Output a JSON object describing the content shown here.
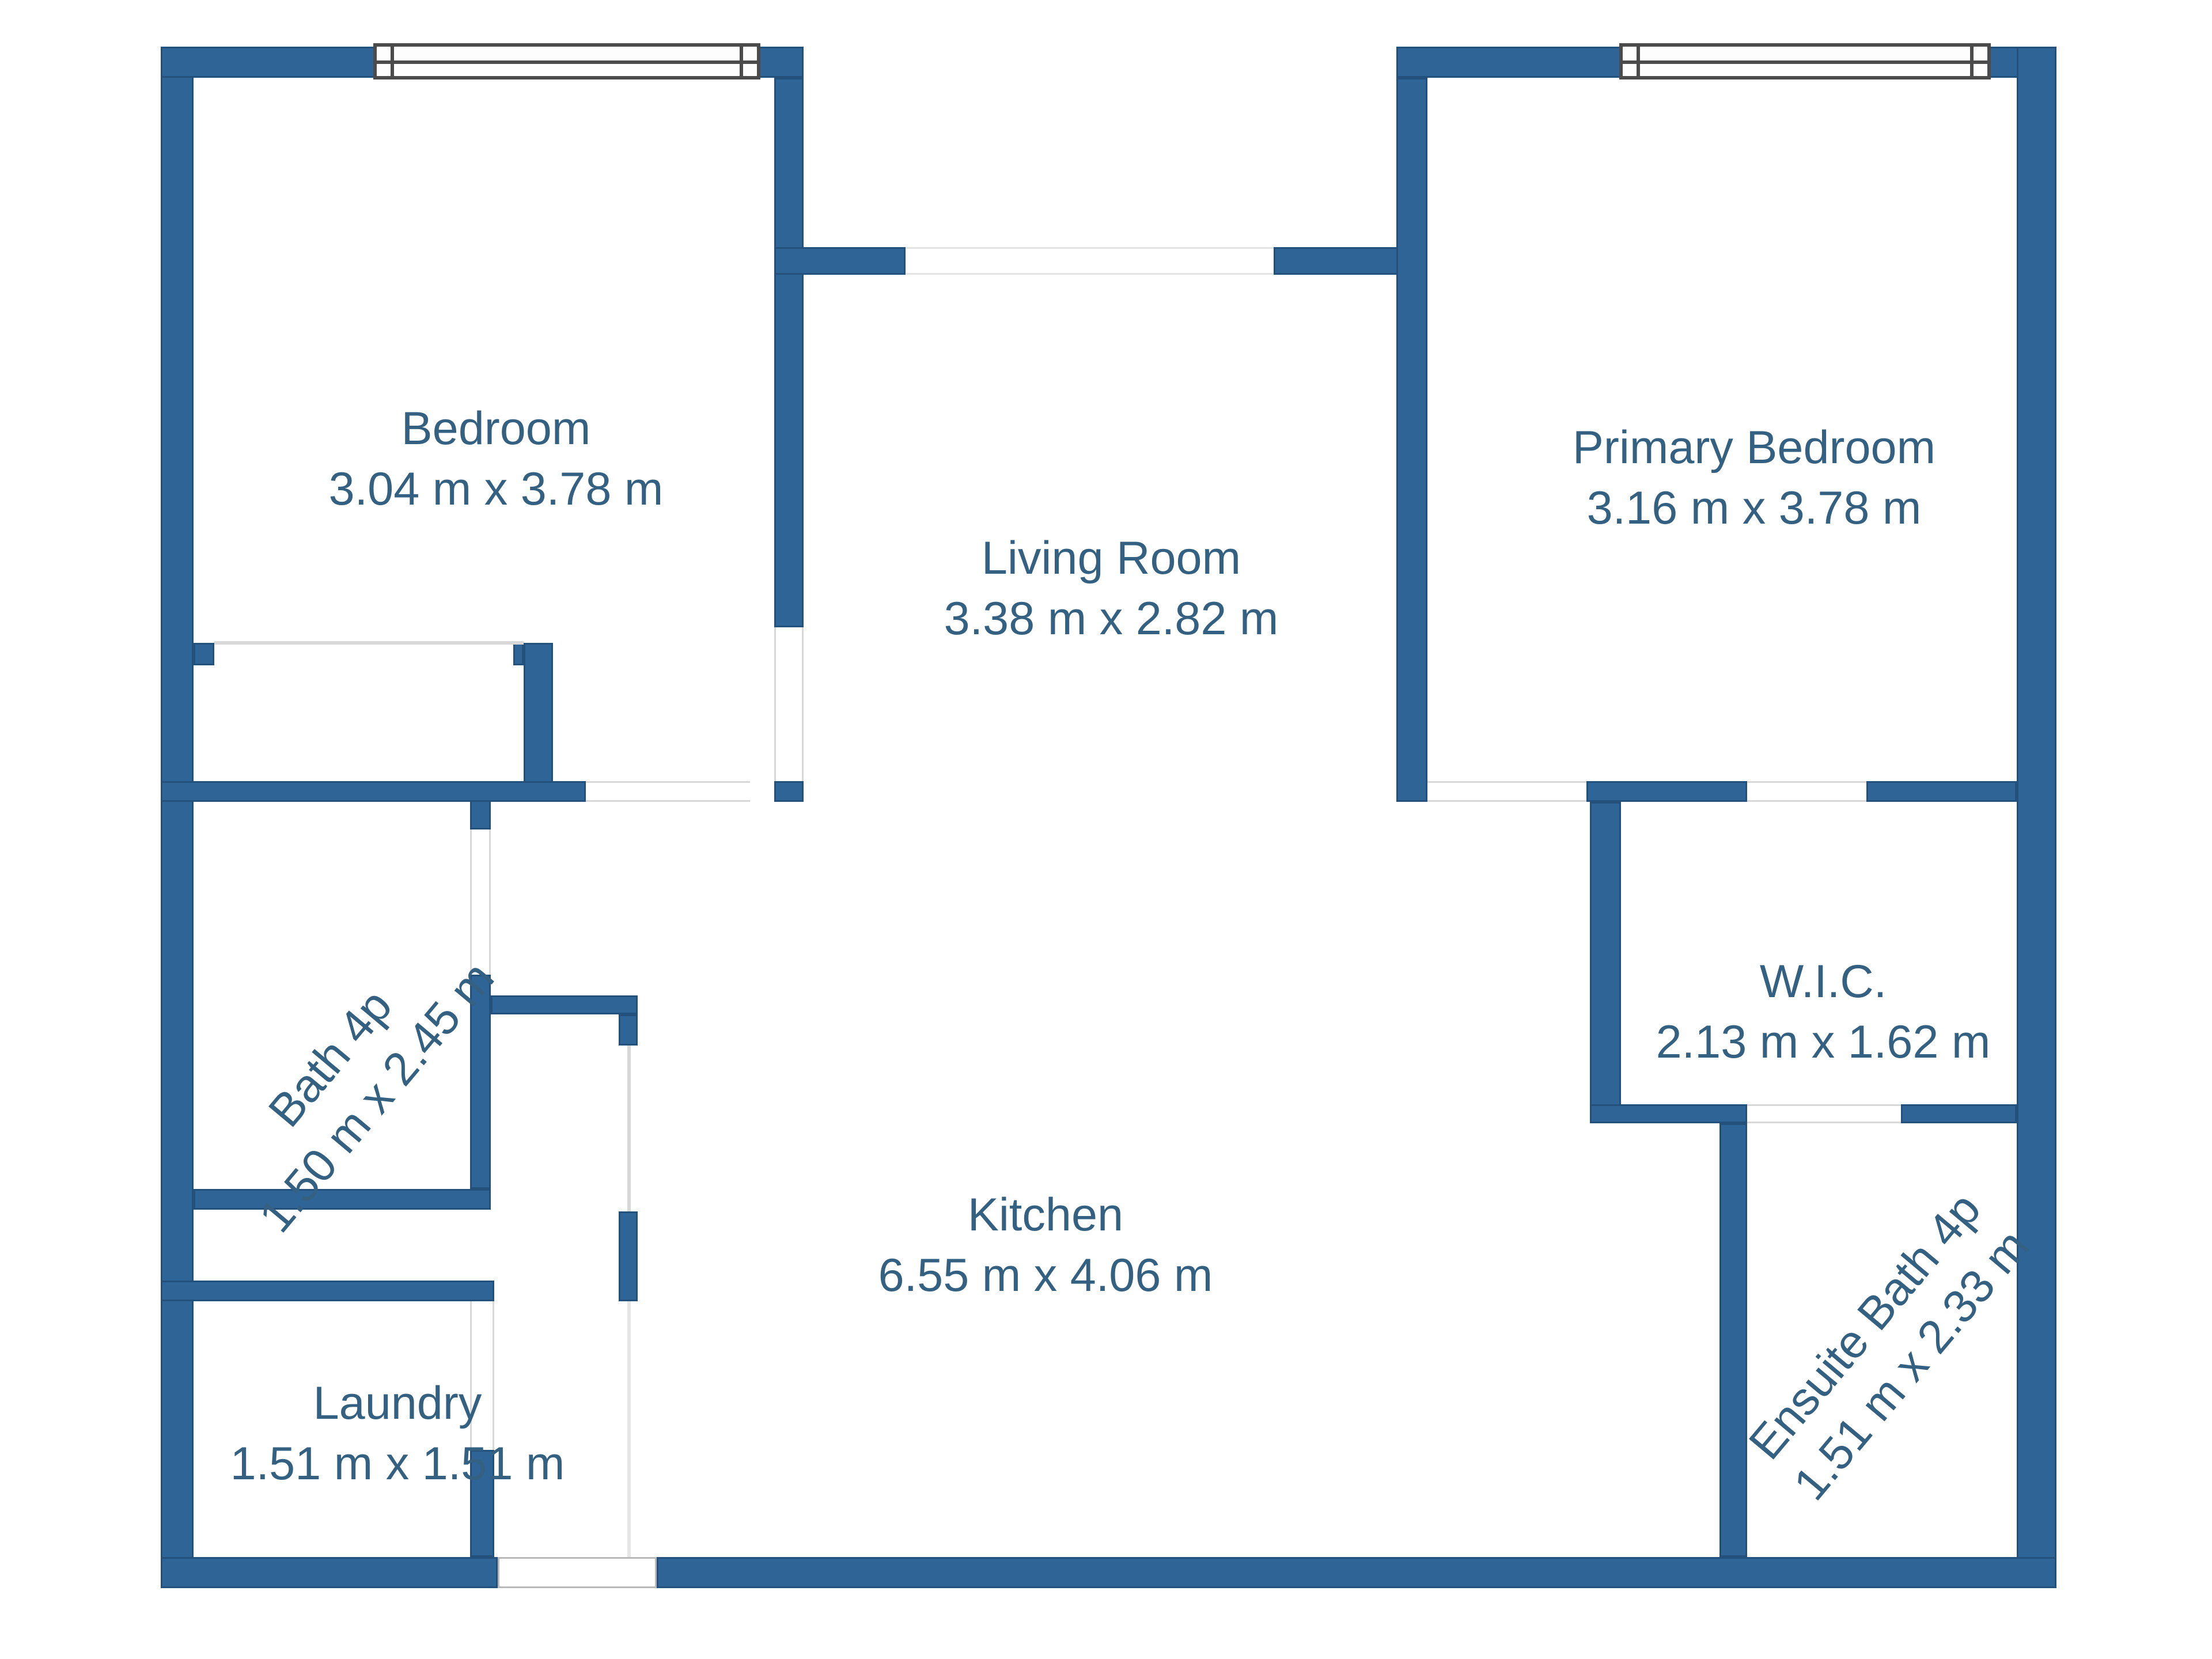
{
  "rooms": [
    {
      "name": "Bedroom",
      "dims": "3.04 m x 3.78 m"
    },
    {
      "name": "Living Room",
      "dims": "3.38 m x 2.82 m"
    },
    {
      "name": "Primary Bedroom",
      "dims": "3.16 m x 3.78 m"
    },
    {
      "name": "Bath 4p",
      "dims": "1.50 m x 2.45 m"
    },
    {
      "name": "Kitchen",
      "dims": "6.55 m x 4.06 m"
    },
    {
      "name": "W.I.C.",
      "dims": "2.13 m x 1.62 m"
    },
    {
      "name": "Laundry",
      "dims": "1.51 m x 1.51 m"
    },
    {
      "name": "Ensuite Bath 4p",
      "dims": "1.51 m x 2.33 m"
    }
  ],
  "windows": [
    {
      "location": "bedroom-top-wall"
    },
    {
      "location": "primary-bedroom-top-wall"
    }
  ],
  "colors": {
    "wall": "#2e6496",
    "wall_border": "#24507c",
    "label_text": "#346181",
    "faint_line": "#d8d8d8",
    "window_frame": "#4b4b4b",
    "background": "#ffffff"
  }
}
